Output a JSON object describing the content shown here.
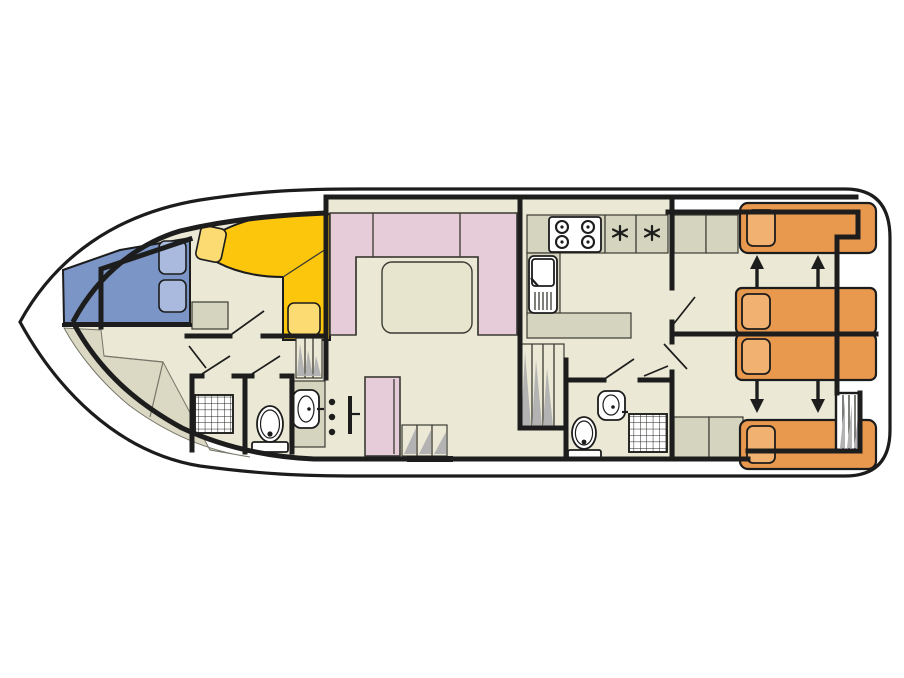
{
  "plan": {
    "title": "houseboat-deck-plan",
    "orientation": "bow-left-stern-right",
    "colors": {
      "outline": "#1c1c1c",
      "wall": "#1d1d1d",
      "thin": "#3a3a33",
      "floor": "#ebe9d5",
      "facet": "#dbd9c3",
      "facet_line": "#76766a",
      "counter": "#d5d4bf",
      "blue_bed": "#7b95c6",
      "blue_pillow": "#a9bade",
      "yellow_sofa": "#fcc60d",
      "yellow_pillow": "#fbdb72",
      "pink": "#e6cbd8",
      "table": "#e7e5ce",
      "orange_bed": "#e9994e",
      "orange_pillow": "#f1b271",
      "hatch": "#b3b3b3"
    },
    "areas": {
      "bow_cabin": {
        "berths": 1,
        "features": [
          "double-berth-blue",
          "two-pillows",
          "l-sofa-yellow",
          "two-cushions",
          "nightstand"
        ]
      },
      "fore_bathroom": {
        "features": [
          "shower",
          "toilet",
          "washbasin-cabinet",
          "coat-hooks",
          "folding-door"
        ]
      },
      "saloon": {
        "features": [
          "u-shaped-sofa-pink",
          "dining-table"
        ]
      },
      "galley": {
        "features": [
          "stove-4-burner",
          "sink-with-drainer",
          "l-shaped-counter",
          "two-storage-hatches"
        ]
      },
      "mid_cabin": {
        "berths": 1,
        "features": [
          "single-berth-pink",
          "entry-steps",
          "threshold"
        ]
      },
      "side_stairs": {
        "features": [
          "companionway-steps-port",
          "companionway-steps-starboard"
        ]
      },
      "aft_bathroom": {
        "features": [
          "washbasin",
          "toilet",
          "shower"
        ]
      },
      "aft_cabin_starboard": {
        "berths": 2,
        "features": [
          "single-berth-orange",
          "sliding-berth-orange",
          "wardrobe-cells",
          "slide-arrows"
        ]
      },
      "aft_cabin_port": {
        "berths": 2,
        "features": [
          "single-berth-orange",
          "sliding-berth-orange",
          "wardrobe-cells",
          "slide-arrows"
        ]
      },
      "stern": {
        "features": [
          "boarding-ladder"
        ]
      }
    },
    "counts": {
      "beds_total": 7,
      "toilets": 2,
      "showers": 2,
      "sinks_bath": 2,
      "sinks_galley": 1,
      "stoves": 1
    }
  }
}
